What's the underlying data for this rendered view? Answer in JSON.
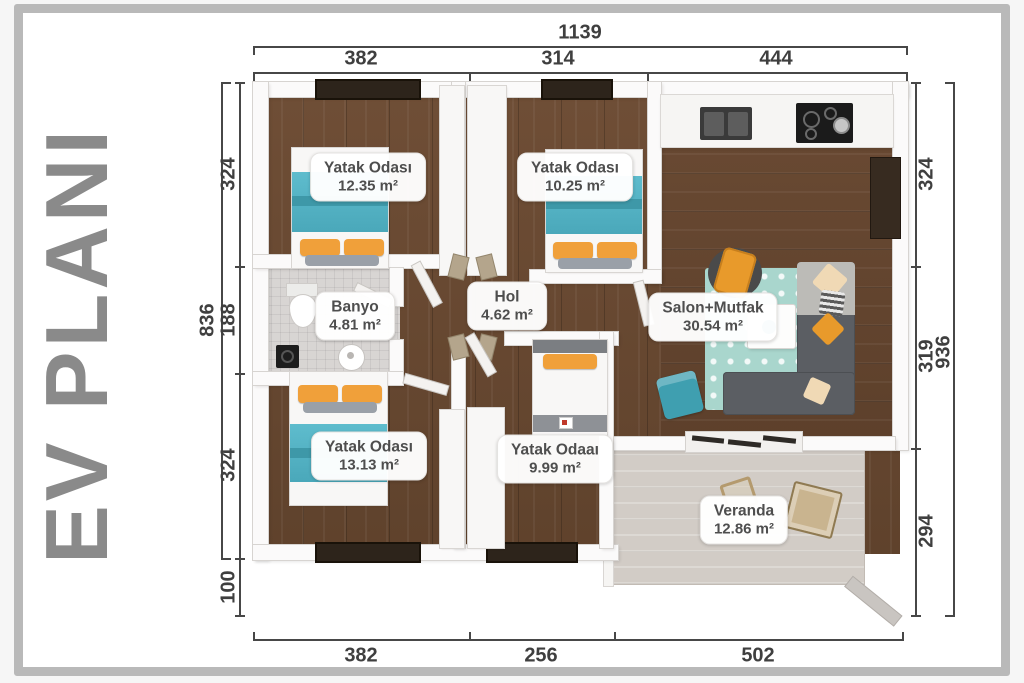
{
  "title": {
    "text": "EV PLANI"
  },
  "rooms": {
    "bedroom1": {
      "name": "Yatak Odası",
      "area": "12.35 m²"
    },
    "bedroom2": {
      "name": "Yatak Odası",
      "area": "10.25 m²"
    },
    "salon": {
      "name": "Salon+Mutfak",
      "area": "30.54 m²"
    },
    "banyo": {
      "name": "Banyo",
      "area": "4.81 m²"
    },
    "hol": {
      "name": "Hol",
      "area": "4.62 m²"
    },
    "bedroom3": {
      "name": "Yatak Odası",
      "area": "13.13 m²"
    },
    "bedroom4": {
      "name": "Yatak Odaaı",
      "area": "9.99 m²"
    },
    "veranda": {
      "name": "Veranda",
      "area": "12.86 m²"
    }
  },
  "dimensions": {
    "top": {
      "total": "1139",
      "segments": [
        "382",
        "314",
        "444"
      ]
    },
    "bottom": {
      "segments": [
        "382",
        "256",
        "502"
      ]
    },
    "left": {
      "total": "836",
      "segments": [
        "324",
        "188",
        "324",
        "100"
      ]
    },
    "right": {
      "total": "936",
      "segments": [
        "324",
        "319",
        "294"
      ]
    }
  },
  "colors": {
    "accent_teal": "#56b7c8",
    "accent_orange": "#f0a03a",
    "floor_wood": "#6a4a33",
    "veranda_floor": "#d2ccc6",
    "title_text": "#8a8a8a",
    "dimension_text": "#3f3f3f",
    "label_text": "#4e4e4e"
  }
}
